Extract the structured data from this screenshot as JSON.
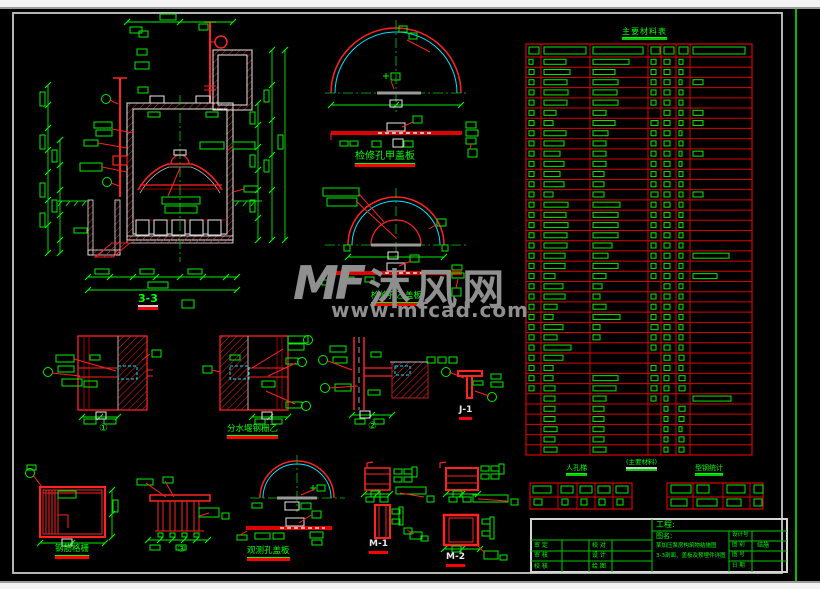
{
  "watermark": {
    "logo": "MF",
    "brand": "沐风网",
    "url": "www.mfcad.com"
  },
  "drawing_labels": {
    "section": "3-3",
    "cover_a": "检修孔甲盖板",
    "cover_b": "检修孔乙盖板",
    "weir_grille": "分水堰钢栅乙",
    "rebar_grating": "钢筋格栅",
    "vent_cover": "观测孔盖板",
    "m1": "M-1",
    "m2": "M-2",
    "j1": "J-1",
    "circle1": "①",
    "circle2": "②",
    "circle3": "③"
  },
  "material_table": {
    "title": "主要材料表",
    "header_blob_widths": [
      10,
      42,
      50,
      9,
      10,
      9,
      52
    ],
    "rows": [
      [
        4,
        22,
        36,
        5,
        6,
        4,
        0
      ],
      [
        5,
        26,
        22,
        5,
        6,
        4,
        0
      ],
      [
        5,
        23,
        25,
        5,
        6,
        3,
        10
      ],
      [
        5,
        24,
        24,
        5,
        6,
        4,
        0
      ],
      [
        5,
        23,
        25,
        5,
        6,
        4,
        0
      ],
      [
        5,
        12,
        13,
        0,
        6,
        4,
        10
      ],
      [
        5,
        9,
        22,
        7,
        6,
        4,
        10
      ],
      [
        5,
        22,
        15,
        5,
        6,
        3,
        0
      ],
      [
        5,
        20,
        13,
        5,
        6,
        4,
        0
      ],
      [
        5,
        16,
        13,
        5,
        6,
        3,
        10
      ],
      [
        5,
        20,
        13,
        5,
        6,
        3,
        0
      ],
      [
        5,
        16,
        11,
        5,
        6,
        4,
        0
      ],
      [
        5,
        20,
        11,
        5,
        6,
        4,
        0
      ],
      [
        5,
        9,
        11,
        7,
        6,
        4,
        10
      ],
      [
        5,
        24,
        27,
        5,
        6,
        4,
        0
      ],
      [
        5,
        22,
        25,
        5,
        6,
        4,
        0
      ],
      [
        5,
        24,
        25,
        5,
        6,
        4,
        0
      ],
      [
        5,
        23,
        25,
        5,
        6,
        4,
        0
      ],
      [
        5,
        23,
        19,
        5,
        6,
        4,
        0
      ],
      [
        5,
        21,
        15,
        5,
        6,
        4,
        36
      ],
      [
        5,
        21,
        25,
        5,
        6,
        4,
        0
      ],
      [
        5,
        11,
        13,
        5,
        6,
        4,
        24
      ],
      [
        5,
        19,
        9,
        0,
        6,
        4,
        0
      ],
      [
        5,
        21,
        7,
        5,
        6,
        4,
        0
      ],
      [
        5,
        13,
        13,
        5,
        6,
        4,
        0
      ],
      [
        5,
        9,
        27,
        5,
        6,
        4,
        0
      ],
      [
        5,
        19,
        7,
        7,
        6,
        4,
        0
      ],
      [
        5,
        13,
        7,
        5,
        6,
        4,
        0
      ],
      [
        5,
        27,
        0,
        5,
        6,
        4,
        0
      ],
      [
        5,
        19,
        0,
        0,
        6,
        5,
        0
      ],
      [
        5,
        9,
        0,
        5,
        6,
        4,
        0
      ],
      [
        5,
        9,
        25,
        7,
        5,
        6,
        0
      ],
      [
        5,
        11,
        23,
        6,
        5,
        6,
        0
      ],
      [
        0,
        11,
        13,
        5,
        4,
        0,
        38
      ],
      [
        0,
        11,
        11,
        0,
        4,
        6,
        0
      ],
      [
        0,
        11,
        11,
        0,
        4,
        5,
        0
      ],
      [
        0,
        13,
        11,
        0,
        4,
        3,
        0
      ],
      [
        0,
        11,
        11,
        0,
        4,
        5,
        0
      ],
      [
        0,
        13,
        13,
        0,
        4,
        5,
        0
      ]
    ]
  },
  "sub_tables": {
    "left_title": "人孔梯",
    "middle_title": "(主要材料)",
    "right_title": "型钢统计",
    "left_blobs_row0": [
      18,
      12,
      12,
      12,
      12
    ],
    "left_blobs_row1": [
      8,
      6,
      6,
      6,
      6
    ],
    "right_blobs_row0": [
      20,
      12,
      18,
      9
    ],
    "right_blobs_row1": [
      16,
      20,
      14,
      8
    ]
  },
  "title_block": {
    "project_label": "工程:",
    "name_label": "图名:",
    "desc_line1": "某加压泵房构筑物结施图",
    "desc_line2": "3-3剖面、盖板及预埋件详图",
    "row1_l": "审 定",
    "row1_r": "校 对",
    "row2_l": "审 核",
    "row2_r": "设 计",
    "row3_l": "校 核",
    "row3_r": "绘 图",
    "r1_label": "设计号",
    "r1_value": "",
    "r2_label": "图 别",
    "r2_value": "结施",
    "r3_label": "图 号",
    "r3_value": "",
    "r4_label": "日 期",
    "r4_value": ""
  },
  "colors": {
    "line_green": "#00ff00",
    "line_red": "#ff0000",
    "line_cyan": "#00e5ff",
    "line_white": "#e8e8e8",
    "table_red": "#dd0000",
    "watermark_gray": "#8f8f8f"
  }
}
